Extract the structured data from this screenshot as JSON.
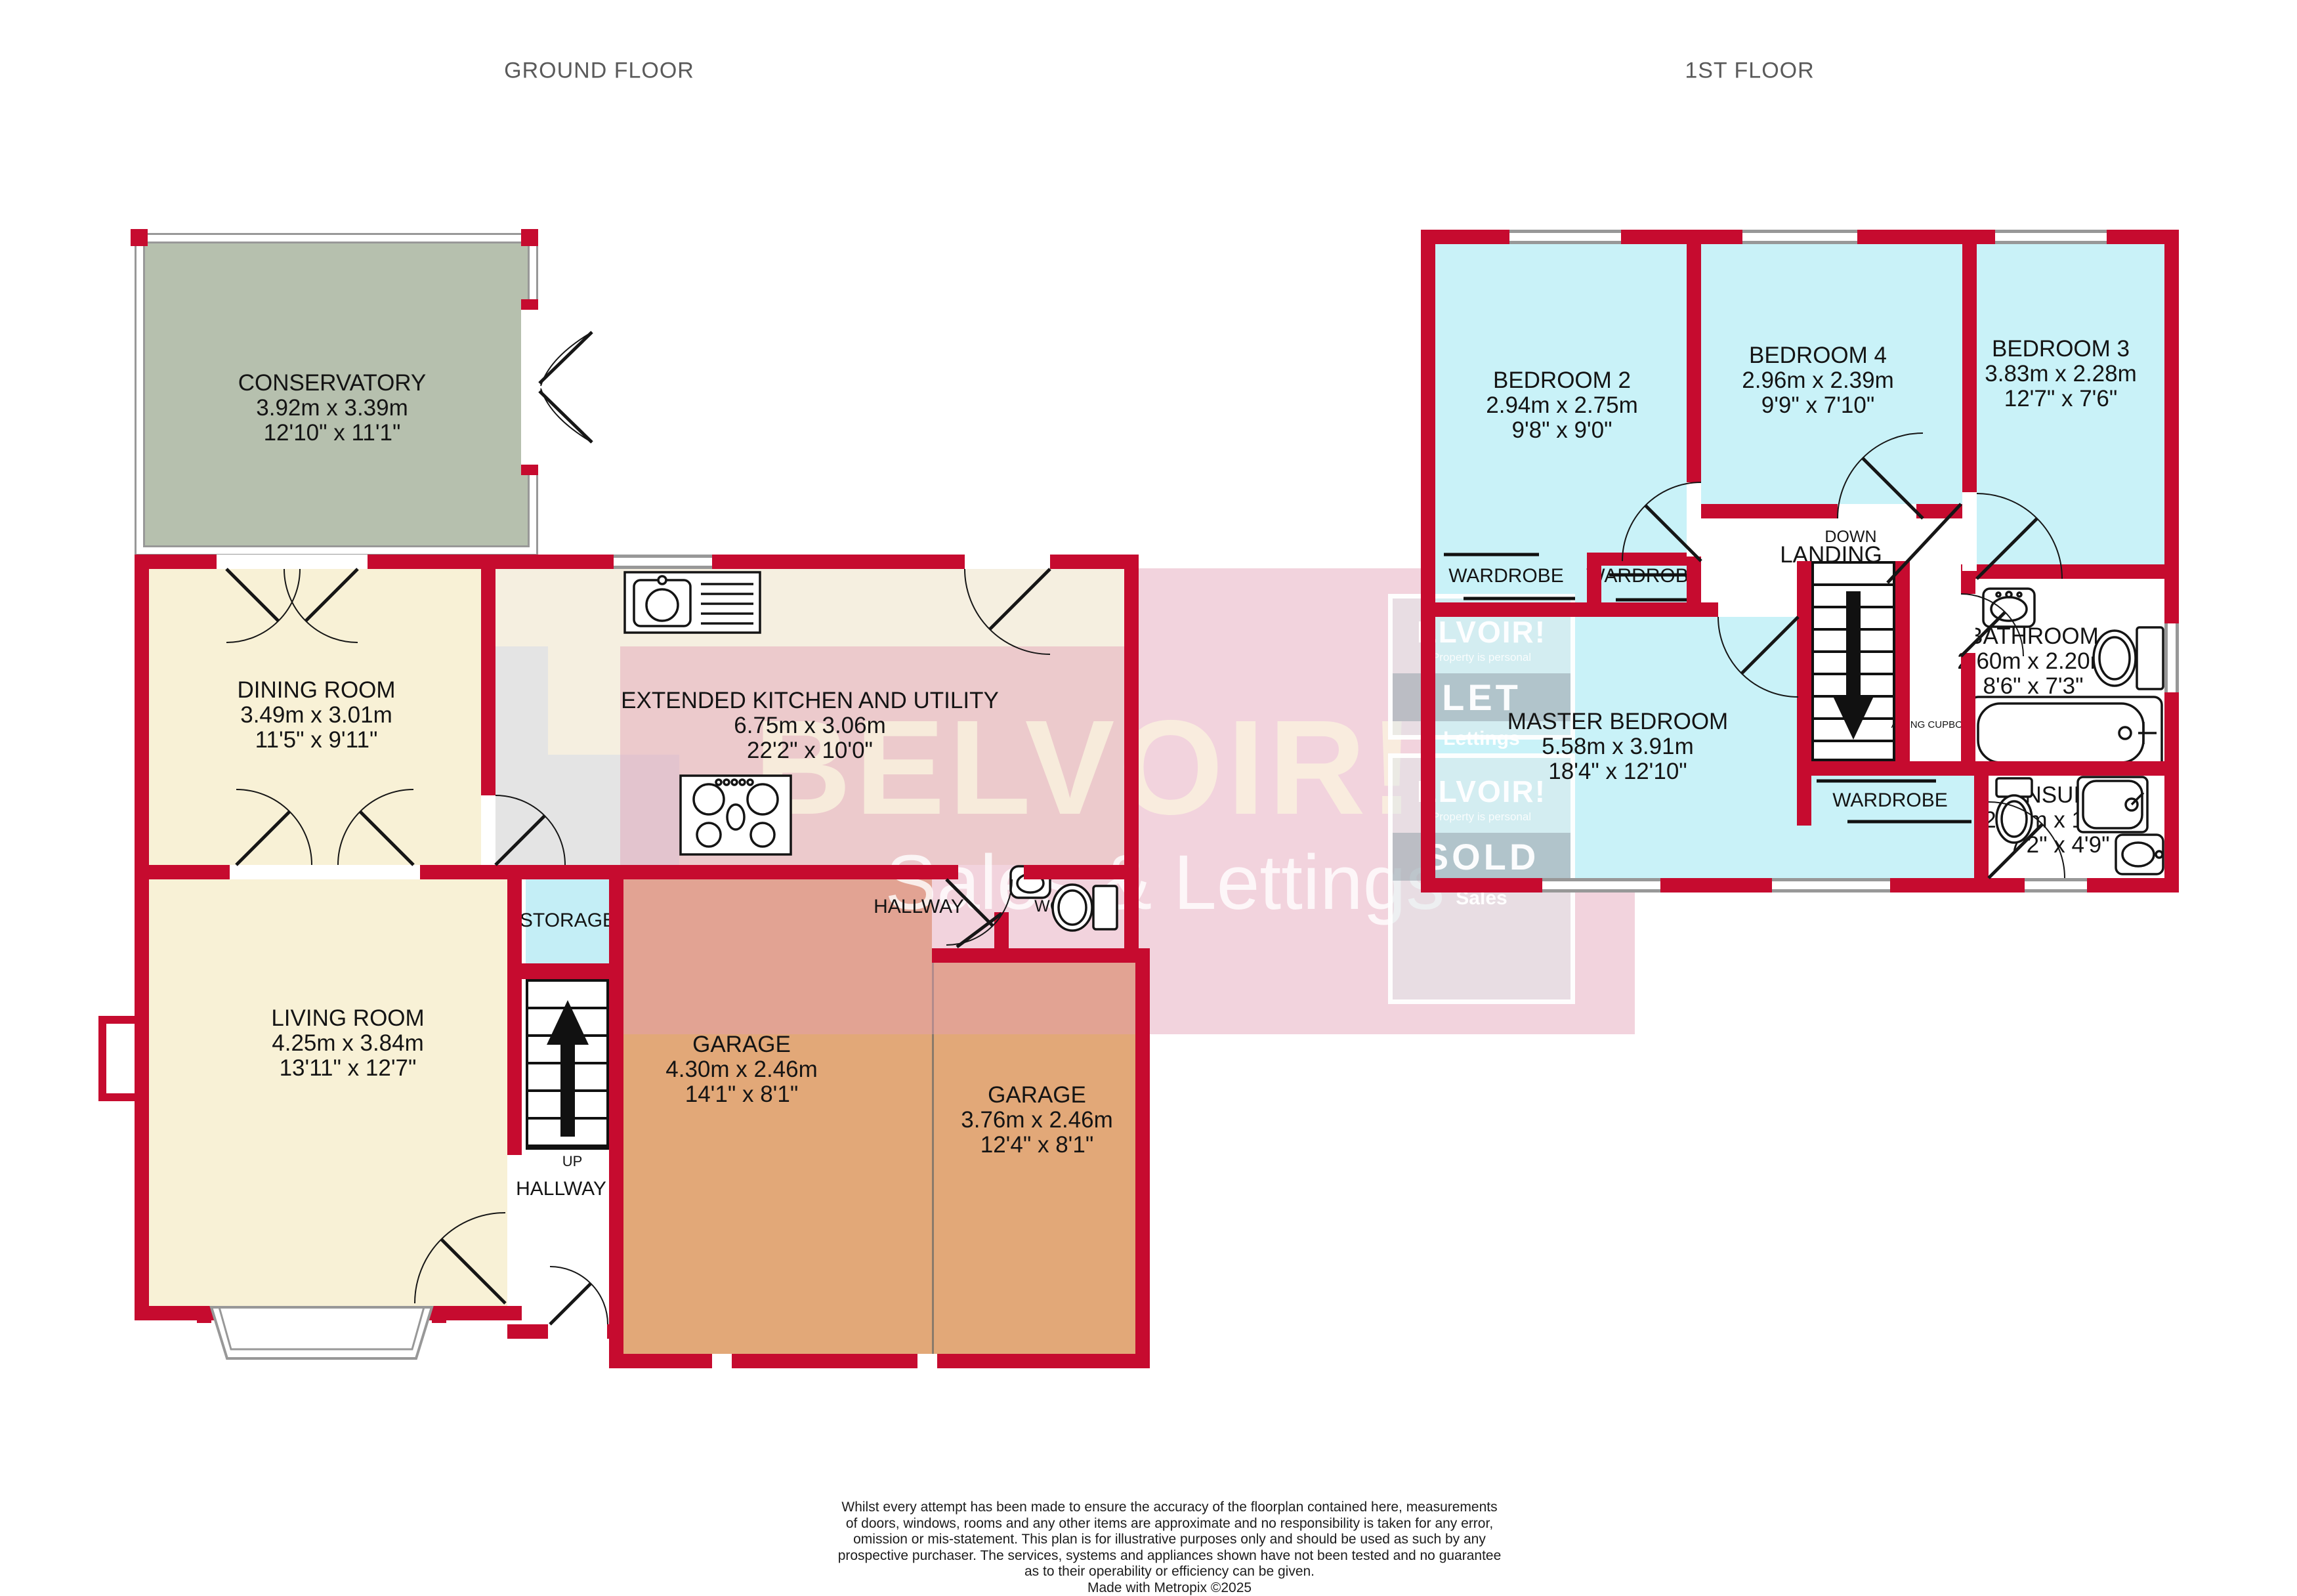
{
  "titles": {
    "ground": "GROUND FLOOR",
    "first": "1ST FLOOR"
  },
  "colors": {
    "wall": "#c60b2f",
    "cream": "#f8f1d6",
    "kitchen": "#f5efe0",
    "cyan": "#c9f2f8",
    "storage": "#c4eef6",
    "green": "#b6c0ae",
    "garage": "#e2a878",
    "pink": "rgba(226,158,179,0.45)",
    "frame": "#989898"
  },
  "rooms": {
    "conservatory": {
      "name": "CONSERVATORY",
      "metric": "3.92m x 3.39m",
      "imperial": "12'10\" x 11'1\""
    },
    "dining": {
      "name": "DINING ROOM",
      "metric": "3.49m x 3.01m",
      "imperial": "11'5\" x 9'11\""
    },
    "living": {
      "name": "LIVING ROOM",
      "metric": "4.25m x 3.84m",
      "imperial": "13'11\" x 12'7\""
    },
    "kitchen": {
      "name": "EXTENDED KITCHEN AND UTILITY",
      "metric": "6.75m x 3.06m",
      "imperial": "22'2\" x 10'0\""
    },
    "garage1": {
      "name": "GARAGE",
      "metric": "4.30m x 2.46m",
      "imperial": "14'1\" x 8'1\""
    },
    "garage2": {
      "name": "GARAGE",
      "metric": "3.76m x 2.46m",
      "imperial": "12'4\" x 8'1\""
    },
    "storage": {
      "name": "STORAGE"
    },
    "hallway1": {
      "name": "HALLWAY"
    },
    "hallway2": {
      "name": "HALLWAY"
    },
    "wc": {
      "name": "WC"
    },
    "bed2": {
      "name": "BEDROOM 2",
      "metric": "2.94m x 2.75m",
      "imperial": "9'8\" x 9'0\""
    },
    "bed4": {
      "name": "BEDROOM 4",
      "metric": "2.96m x 2.39m",
      "imperial": "9'9\" x 7'10\""
    },
    "bed3": {
      "name": "BEDROOM 3",
      "metric": "3.83m x 2.28m",
      "imperial": "12'7\" x 7'6\""
    },
    "master": {
      "name": "MASTER BEDROOM",
      "metric": "5.58m x 3.91m",
      "imperial": "18'4\" x 12'10\""
    },
    "bathroom": {
      "name": "BATHROOM",
      "metric": "2.60m x 2.20m",
      "imperial": "8'6\" x 7'3\""
    },
    "ensuite": {
      "name": "ENSUITE",
      "metric": "2.18m x 1.44m",
      "imperial": "7'2\" x 4'9\""
    },
    "landing": {
      "name": "LANDING"
    }
  },
  "markers": {
    "up": "UP",
    "down": "DOWN",
    "wardrobe1": "WARDROBE",
    "wardrobe2": "WARDROBE",
    "wardrobe3": "WARDROBE",
    "airing": "AIRING CUPBOARD"
  },
  "watermark": {
    "brand": "BELVOIR!",
    "tagline": "Sales & Lettings",
    "board_brand": "ELVOIR!",
    "board_tag": "Property is personal",
    "let": "LET",
    "lettings": "Lettings",
    "sold": "SOLD",
    "sales": "Sales"
  },
  "footer": {
    "lines": [
      "Whilst every attempt has been made to ensure the accuracy of the floorplan contained here, measurements",
      "of doors, windows, rooms and any other items are approximate and no responsibility is taken for any error,",
      "omission or mis-statement. This plan is for illustrative purposes only and should be used as such by any",
      "prospective purchaser. The services, systems and appliances shown have not been tested and no guarantee",
      "as to their operability or efficiency can be given.",
      "Made with Metropix ©2025"
    ]
  }
}
